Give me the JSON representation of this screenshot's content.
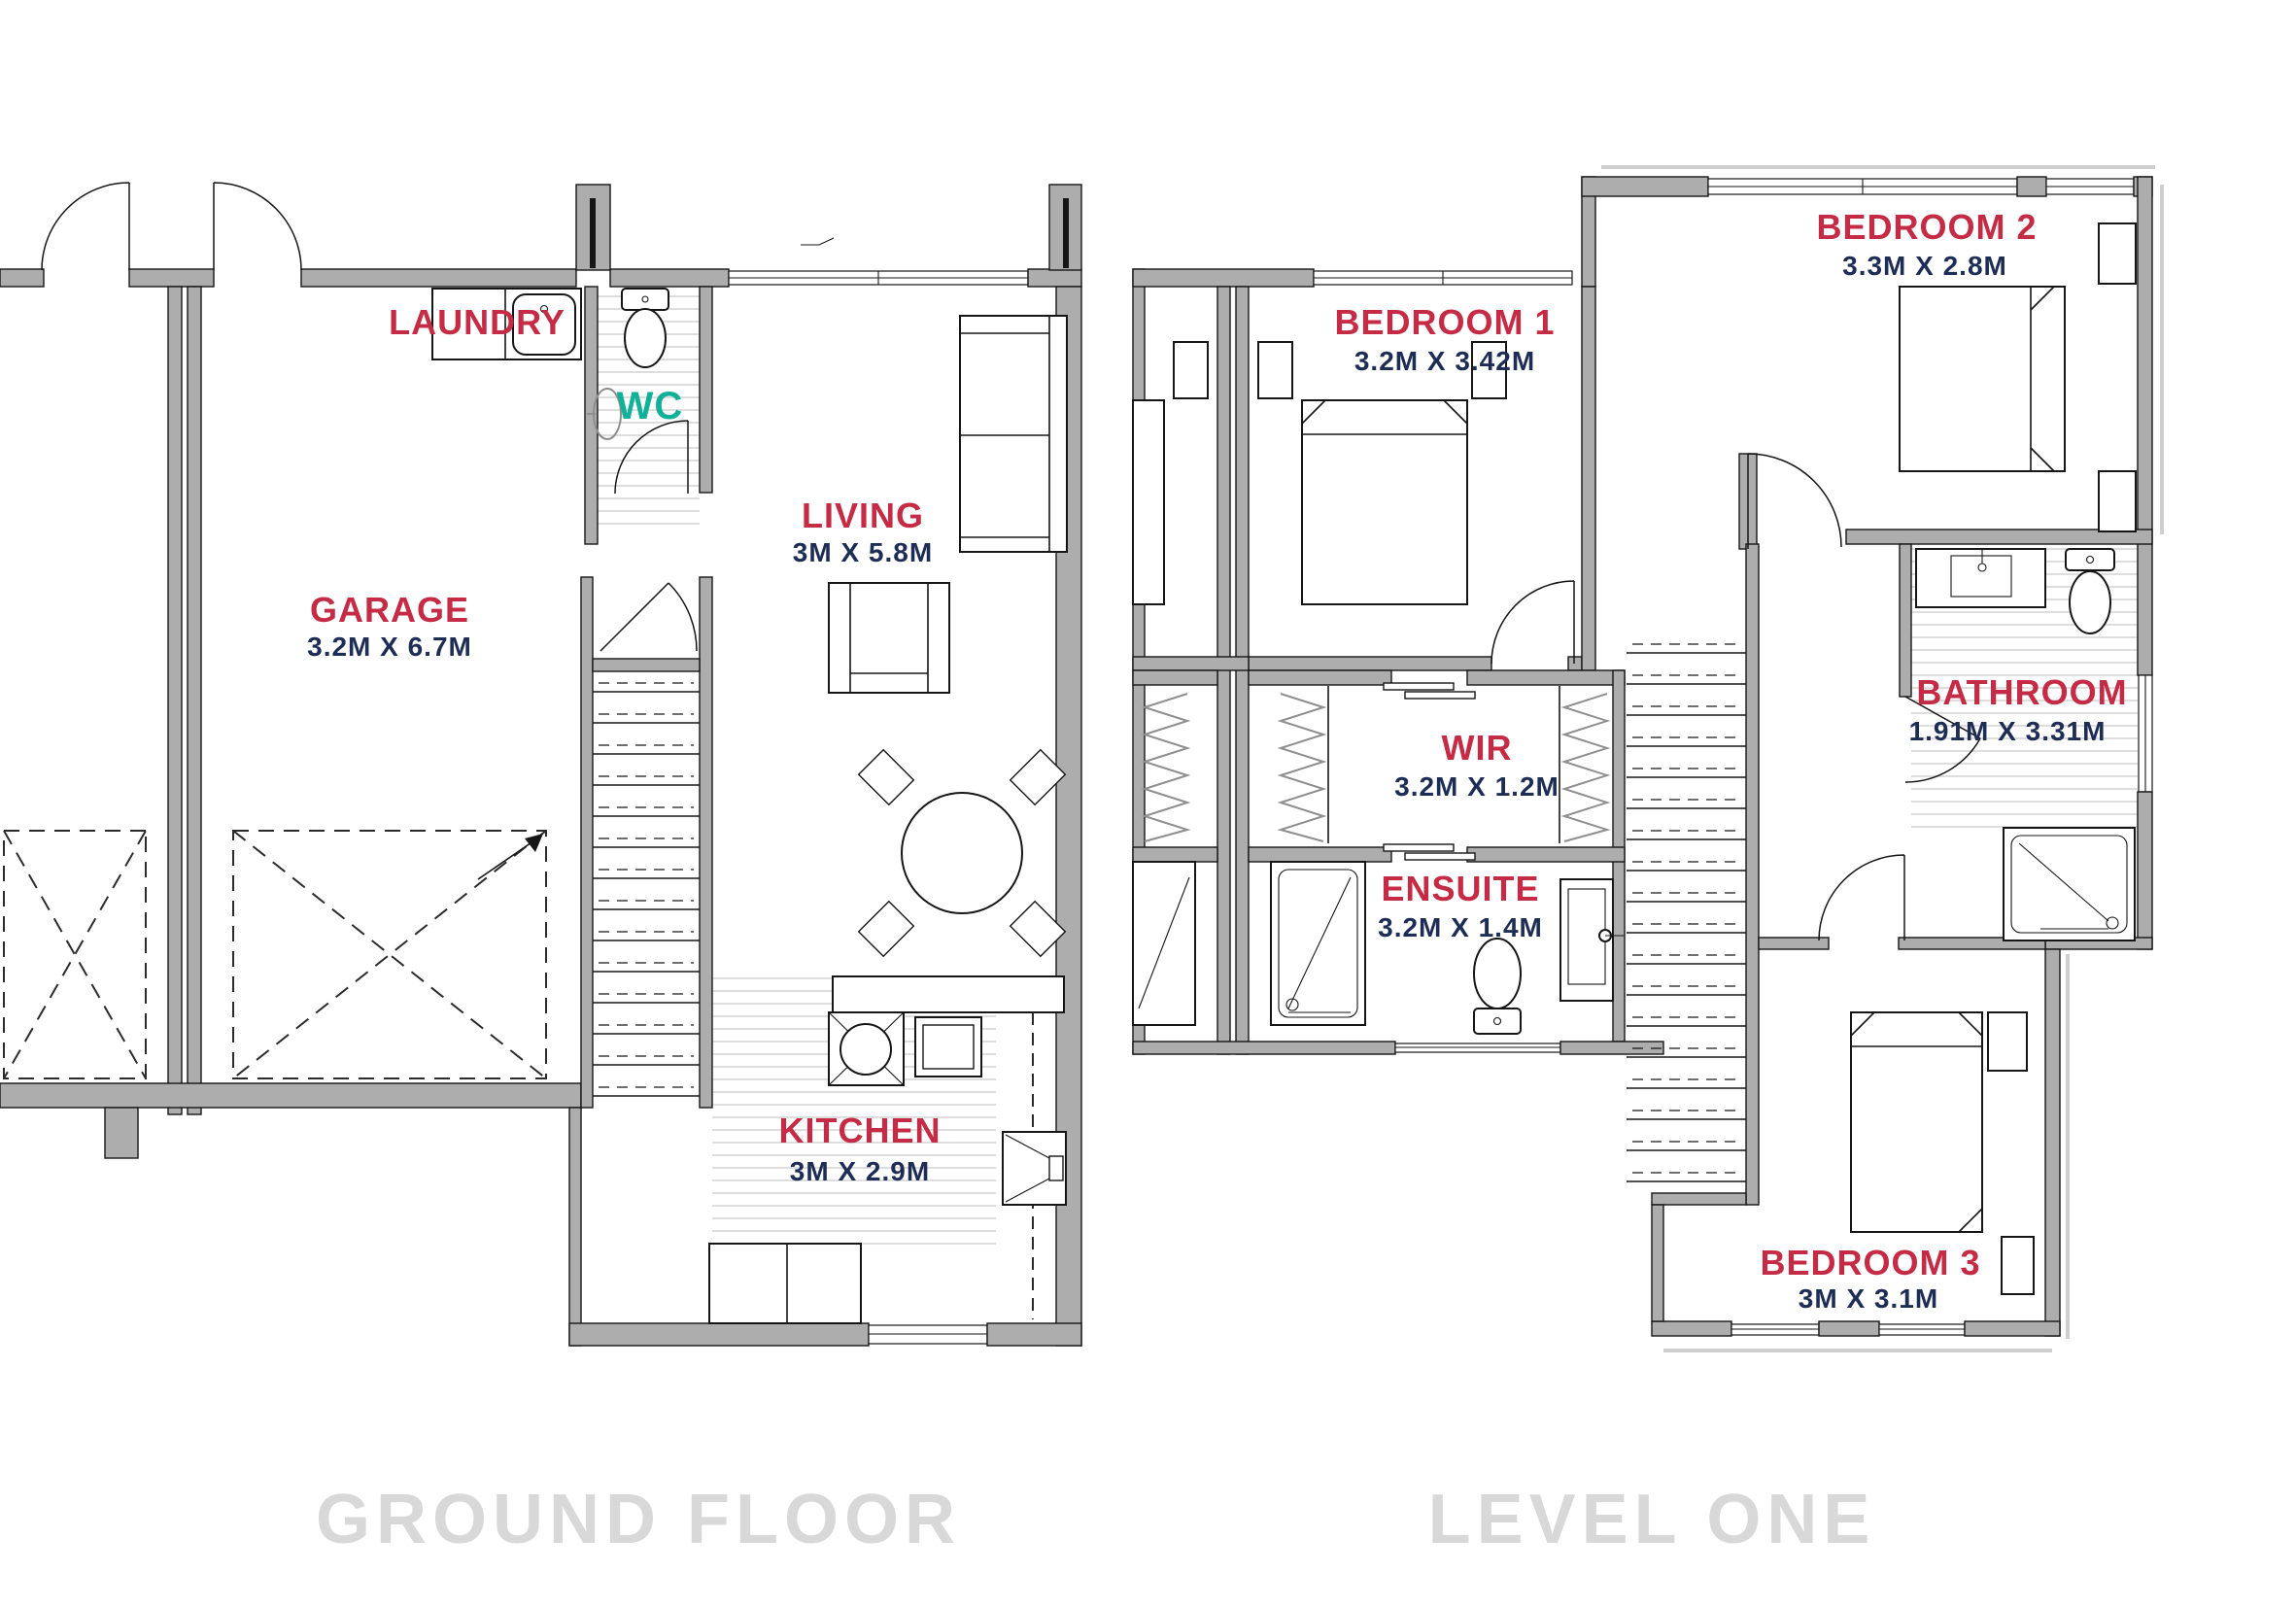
{
  "document": {
    "type": "architectural floor plan, two storeys, townhouse"
  },
  "colors": {
    "room_label": "#C52B44",
    "dimension_label": "#1E2D55",
    "wc_label": "#11B098",
    "wall_fill": "#ADADAD",
    "floor_title": "#D8D8D8"
  },
  "ground_floor": {
    "title": "GROUND FLOOR",
    "rooms": {
      "laundry": {
        "name": "LAUNDRY"
      },
      "wc": {
        "name": "WC"
      },
      "living": {
        "name": "LIVING",
        "dims": "3M X 5.8M"
      },
      "garage": {
        "name": "GARAGE",
        "dims": "3.2M X 6.7M"
      },
      "kitchen": {
        "name": "KITCHEN",
        "dims": "3M X 2.9M"
      }
    }
  },
  "level_one": {
    "title": "LEVEL ONE",
    "rooms": {
      "bedroom1": {
        "name": "BEDROOM 1",
        "dims": "3.2M X 3.42M"
      },
      "bedroom2": {
        "name": "BEDROOM 2",
        "dims": "3.3M X 2.8M"
      },
      "bathroom": {
        "name": "BATHROOM",
        "dims": "1.91M X 3.31M"
      },
      "wir": {
        "name": "WIR",
        "dims": "3.2M X 1.2M"
      },
      "ensuite": {
        "name": "ENSUITE",
        "dims": "3.2M X 1.4M"
      },
      "bedroom3": {
        "name": "BEDROOM 3",
        "dims": "3M X 3.1M"
      }
    }
  }
}
